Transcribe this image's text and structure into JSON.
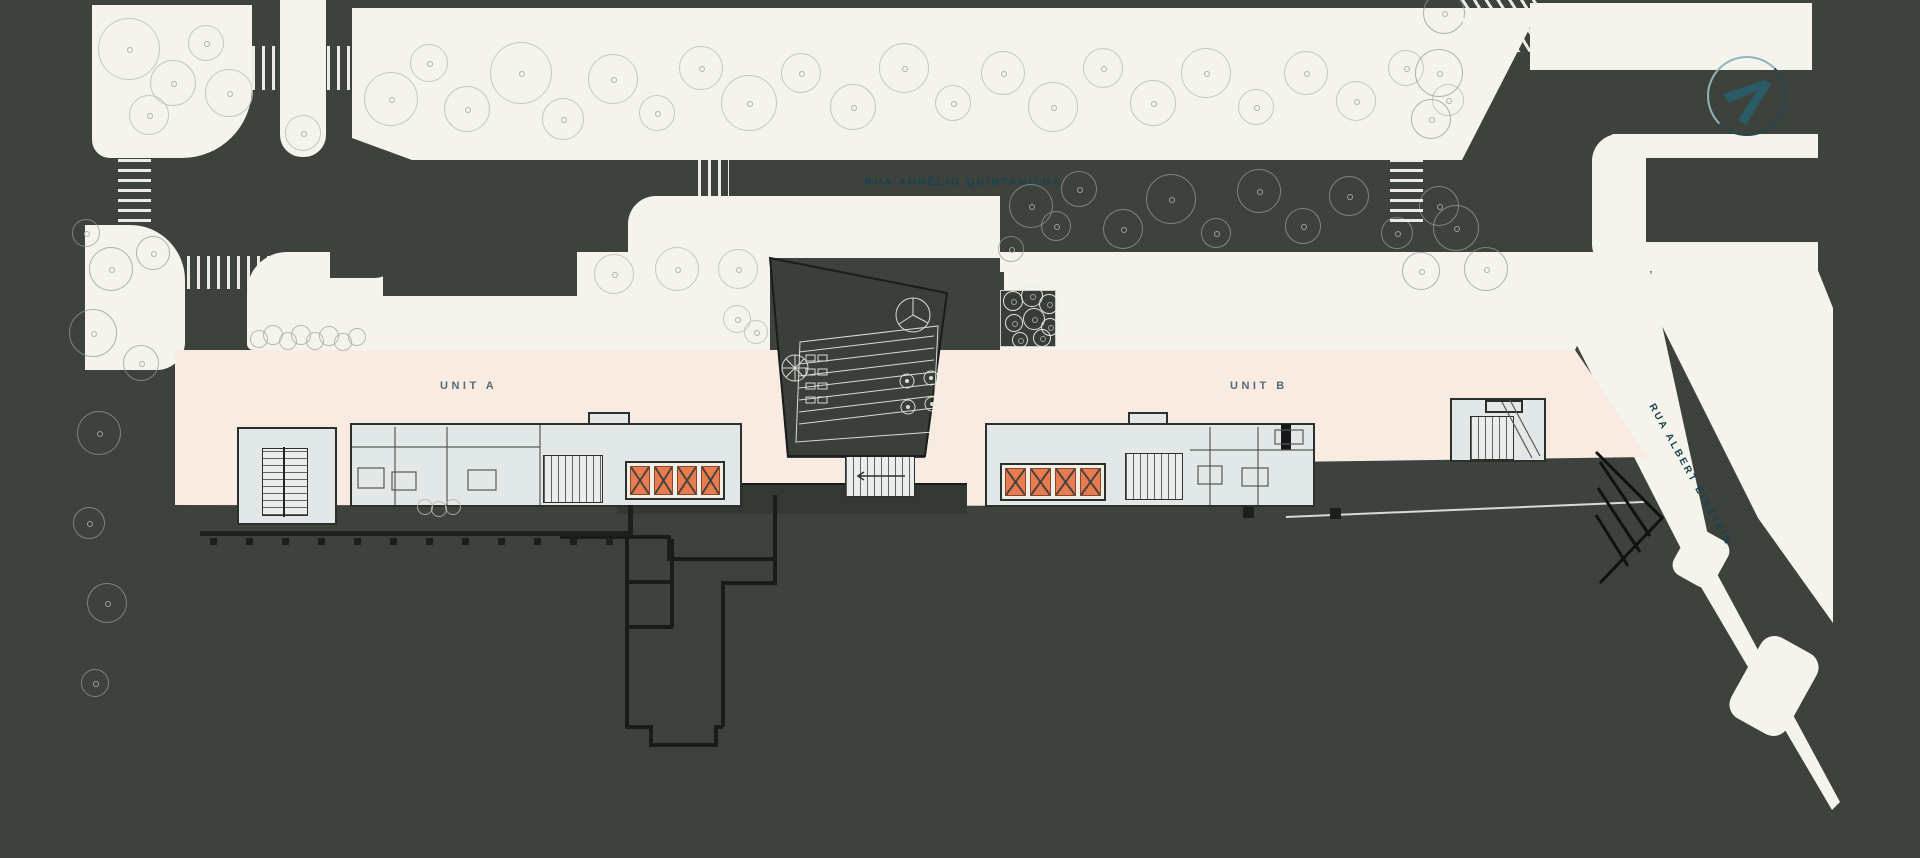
{
  "labels": {
    "street_top": "RUA AURÉLIO QUINTANILHA",
    "street_right": "RUA ALBERT EINSTEIN",
    "unit_a": "UNIT A",
    "unit_b": "UNIT B"
  },
  "colors": {
    "background": "#3d423c",
    "paving": "#f4f4ec",
    "floorplate": "#f9ebe2",
    "core_fill": "#e2e7e7",
    "elevator_orange": "#e87b50",
    "street_text": "#17434f",
    "unit_text": "#4f6d77",
    "outline_black": "#1a1d19"
  },
  "compass": {
    "icon": "north-arrow-icon"
  },
  "site": {
    "elevator_banks": [
      {
        "x": 625,
        "y": 461,
        "w": 100,
        "h": 39,
        "cells": 4
      },
      {
        "x": 1000,
        "y": 463,
        "w": 106,
        "h": 38,
        "cells": 4
      }
    ],
    "crosswalks": [
      {
        "x": 252,
        "y": 46,
        "w": 27,
        "h": 44,
        "angle": 90
      },
      {
        "x": 327,
        "y": 46,
        "w": 27,
        "h": 44,
        "angle": 90
      },
      {
        "x": 118,
        "y": 140,
        "w": 33,
        "h": 92,
        "angle": 0
      },
      {
        "x": 187,
        "y": 256,
        "w": 92,
        "h": 33,
        "angle": 90
      },
      {
        "x": 698,
        "y": 156,
        "w": 31,
        "h": 40,
        "angle": 90
      },
      {
        "x": 1390,
        "y": 158,
        "w": 33,
        "h": 64,
        "angle": 0
      },
      {
        "x": 1458,
        "y": 0,
        "w": 80,
        "h": 52,
        "angle": 58
      }
    ],
    "trees_light": [
      [
        128,
        48,
        30
      ],
      [
        172,
        82,
        22
      ],
      [
        205,
        42,
        17
      ],
      [
        148,
        114,
        19
      ],
      [
        228,
        92,
        23
      ],
      [
        302,
        132,
        17
      ],
      [
        390,
        98,
        26
      ],
      [
        428,
        62,
        18
      ],
      [
        466,
        108,
        22
      ],
      [
        520,
        72,
        30
      ],
      [
        562,
        118,
        20
      ],
      [
        612,
        78,
        24
      ],
      [
        656,
        112,
        17
      ],
      [
        700,
        67,
        21
      ],
      [
        748,
        102,
        27
      ],
      [
        800,
        72,
        19
      ],
      [
        852,
        106,
        22
      ],
      [
        903,
        67,
        24
      ],
      [
        952,
        102,
        17
      ],
      [
        1002,
        72,
        21
      ],
      [
        1052,
        106,
        24
      ],
      [
        1102,
        67,
        19
      ],
      [
        1152,
        102,
        22
      ],
      [
        1205,
        72,
        24
      ],
      [
        1255,
        106,
        17
      ],
      [
        1305,
        72,
        21
      ],
      [
        1355,
        100,
        19
      ],
      [
        1405,
        67,
        17
      ],
      [
        1447,
        99,
        15
      ],
      [
        613,
        273,
        19
      ],
      [
        676,
        268,
        21
      ],
      [
        737,
        268,
        19
      ],
      [
        736,
        318,
        13
      ],
      [
        755,
        331,
        11
      ]
    ],
    "trees_dark": [
      [
        85,
        232,
        13
      ],
      [
        110,
        268,
        21
      ],
      [
        152,
        252,
        16
      ],
      [
        92,
        332,
        23
      ],
      [
        140,
        362,
        17
      ],
      [
        98,
        432,
        21
      ],
      [
        88,
        522,
        15
      ],
      [
        106,
        602,
        19
      ],
      [
        94,
        682,
        13
      ],
      [
        1030,
        205,
        21
      ],
      [
        1078,
        188,
        17
      ],
      [
        1122,
        228,
        19
      ],
      [
        1170,
        198,
        24
      ],
      [
        1215,
        232,
        14
      ],
      [
        1258,
        190,
        21
      ],
      [
        1302,
        225,
        17
      ],
      [
        1348,
        195,
        19
      ],
      [
        1396,
        232,
        15
      ],
      [
        1438,
        205,
        19
      ],
      [
        1443,
        12,
        20
      ],
      [
        1438,
        72,
        23
      ],
      [
        1430,
        118,
        19
      ],
      [
        1455,
        227,
        22
      ],
      [
        1420,
        270,
        18
      ],
      [
        1485,
        268,
        21
      ],
      [
        1010,
        248,
        12
      ],
      [
        1055,
        225,
        14
      ]
    ],
    "planter_trees": [
      [
        1012,
        300,
        9
      ],
      [
        1031,
        295,
        10
      ],
      [
        1048,
        303,
        9
      ],
      [
        1013,
        322,
        8
      ],
      [
        1033,
        318,
        10
      ],
      [
        1049,
        326,
        8
      ],
      [
        1019,
        339,
        7
      ],
      [
        1041,
        337,
        8
      ]
    ],
    "bushes": [
      [
        258,
        338,
        8
      ],
      [
        272,
        334,
        9
      ],
      [
        287,
        340,
        8
      ],
      [
        300,
        334,
        9
      ],
      [
        314,
        340,
        8
      ],
      [
        328,
        335,
        9
      ],
      [
        342,
        341,
        8
      ],
      [
        356,
        336,
        8
      ],
      [
        424,
        506,
        7
      ],
      [
        438,
        508,
        7
      ],
      [
        452,
        506,
        7
      ]
    ]
  }
}
